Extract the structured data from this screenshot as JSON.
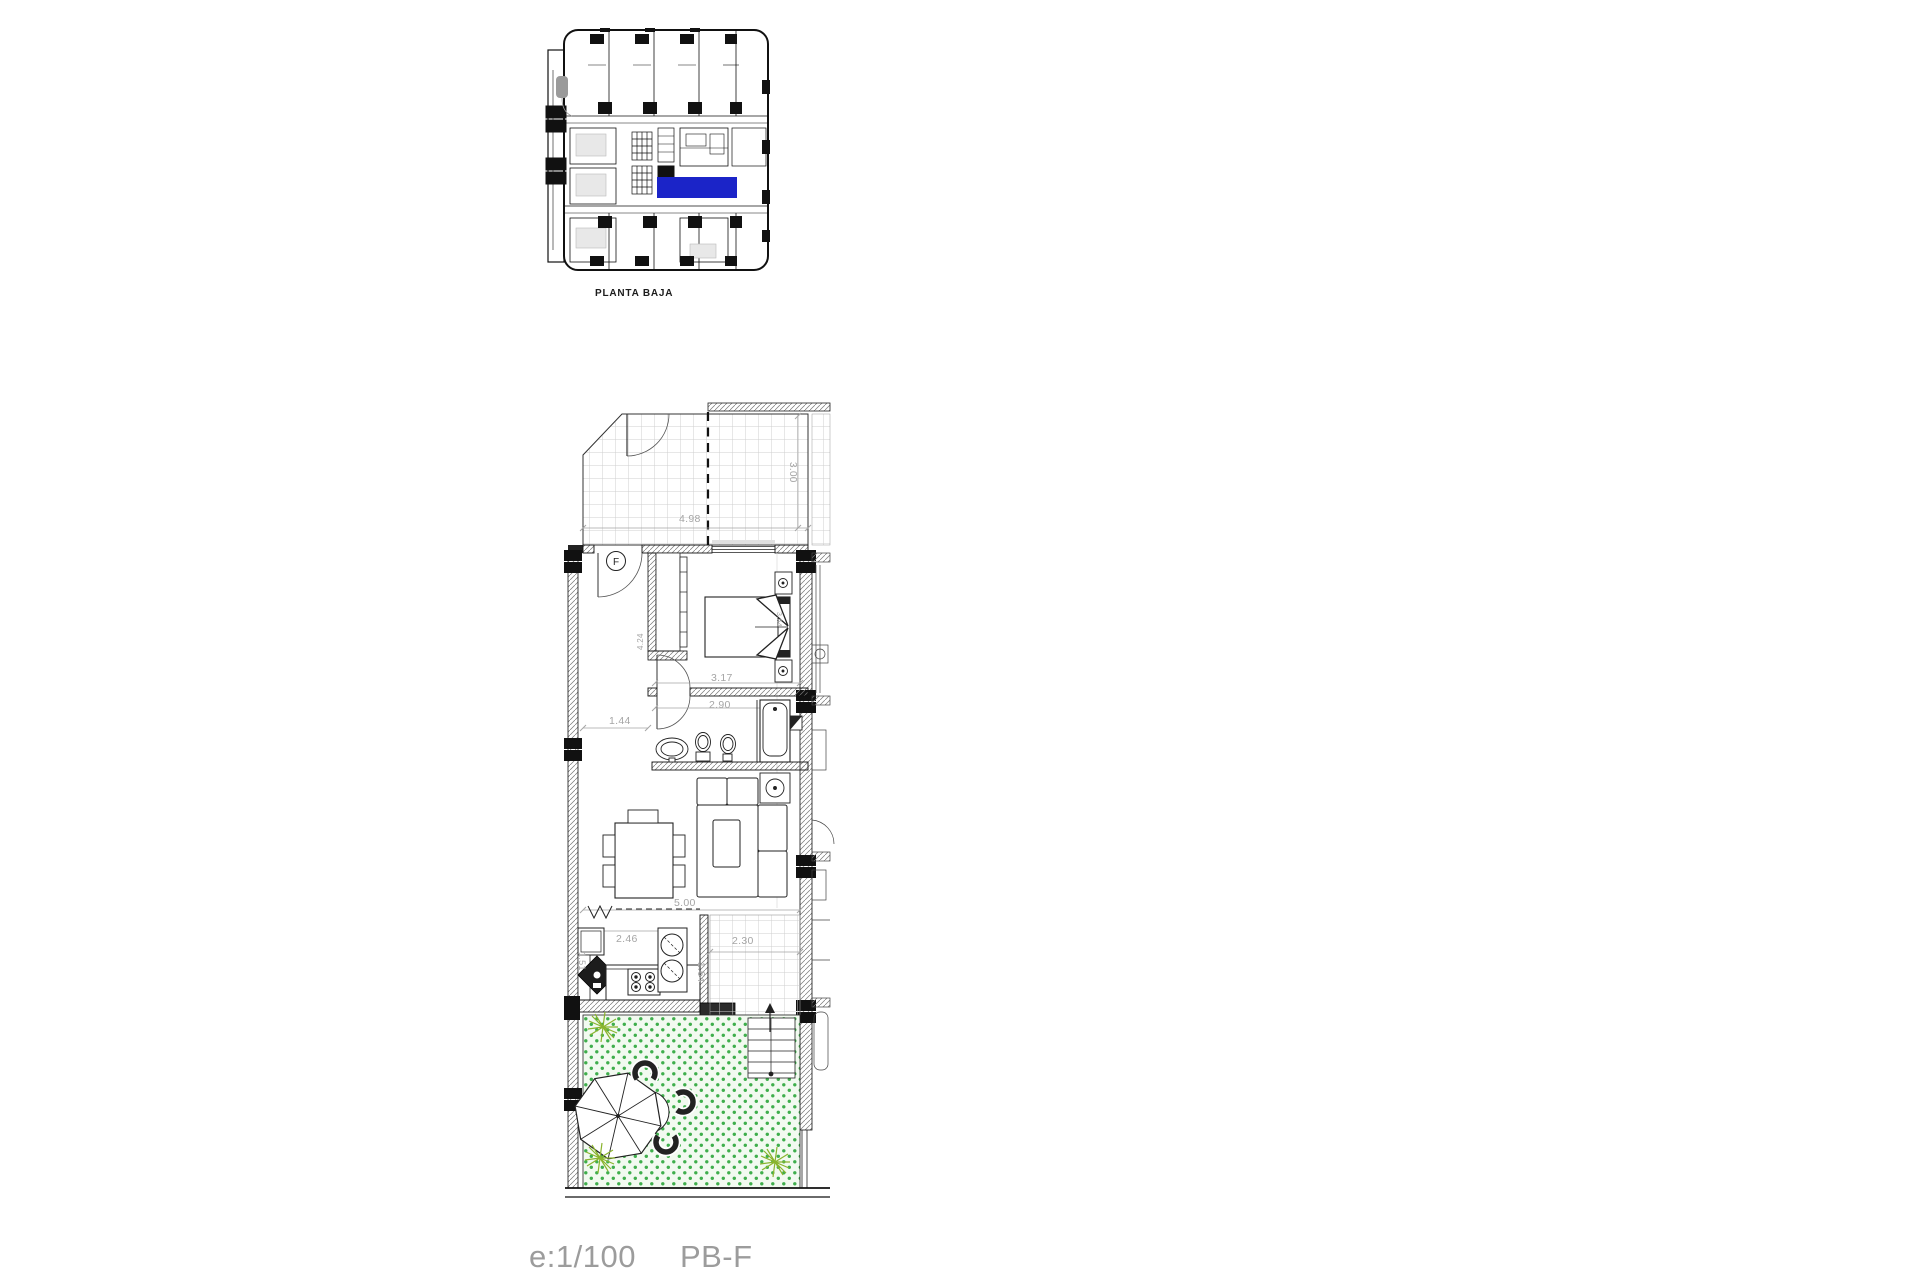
{
  "overview": {
    "caption": "PLANTA BAJA",
    "highlighted_unit": "F"
  },
  "plan": {
    "unit_letter": "F",
    "dims": {
      "terrace_width": "4.98",
      "terrace_depth": "3.00",
      "wardrobe_depth": "4.24",
      "bedroom_width": "3.17",
      "bathroom_width": "2.90",
      "hall_width": "1.44",
      "bed_depth": "3.64",
      "living_width": "5.00",
      "kitchen_width": "2.46",
      "kitchen_depth": "1.51",
      "patio_width": "2.30",
      "patio_depth": "1.64"
    }
  },
  "footer": {
    "scale": "e:1/100",
    "code": "PB-F"
  },
  "colors": {
    "highlight": "#1b24c8",
    "garden_dot": "#3fae4c",
    "garden_bg": "#f2faf0",
    "plant": "#8ab42e",
    "dim_text": "#a5a5a5",
    "tile": "#cfcfcf",
    "ink": "#1a1a1a",
    "caption": "#9c9c9c"
  }
}
